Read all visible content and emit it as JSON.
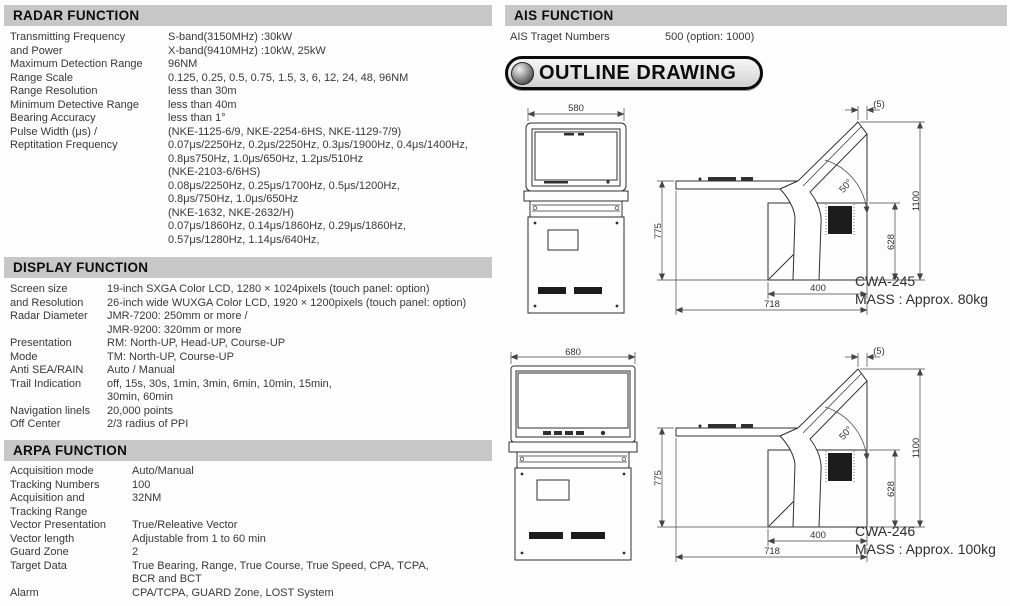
{
  "sections": {
    "radar": {
      "title": "RADAR FUNCTION",
      "rows": [
        {
          "label": "Transmitting Frequency",
          "value": "S-band(3150MHz) :30kW"
        },
        {
          "label": "and Power",
          "value": "X-band(9410MHz) :10kW, 25kW"
        },
        {
          "label": "Maximum Detection Range",
          "value": "96NM"
        },
        {
          "label": "Range Scale",
          "value": "0.125, 0.25, 0.5, 0.75, 1.5, 3, 6, 12, 24, 48, 96NM"
        },
        {
          "label": "Range Resolution",
          "value": "less than 30m"
        },
        {
          "label": "Minimum Detective Range",
          "value": "less than 40m"
        },
        {
          "label": "Bearing Accuracy",
          "value": "less than 1°"
        },
        {
          "label": "Pulse Width (μs) /",
          "value": "(NKE-1125-6/9, NKE-2254-6HS, NKE-1129-7/9)"
        },
        {
          "label": "Reptitation Frequency",
          "value": "0.07μs/2250Hz, 0.2μs/2250Hz, 0.3μs/1900Hz, 0.4μs/1400Hz,"
        },
        {
          "label": "",
          "value": "0.8μs750Hz, 1.0μs/650Hz, 1.2μs/510Hz"
        },
        {
          "label": "",
          "value": "(NKE-2103-6/6HS)"
        },
        {
          "label": "",
          "value": "0.08μs/2250Hz, 0.25μs/1700Hz, 0.5μs/1200Hz,"
        },
        {
          "label": "",
          "value": "0.8μs/750Hz, 1.0μs/650Hz"
        },
        {
          "label": "",
          "value": "(NKE-1632, NKE-2632/H)"
        },
        {
          "label": "",
          "value": "0.07μs/1860Hz, 0.14μs/1860Hz, 0.29μs/1860Hz,"
        },
        {
          "label": "",
          "value": "0.57μs/1280Hz, 1.14μs/640Hz,"
        }
      ]
    },
    "display": {
      "title": "DISPLAY FUNCTION",
      "rows": [
        {
          "label": "Screen size",
          "value": "19-inch SXGA Color LCD, 1280 × 1024pixels (touch panel: option)"
        },
        {
          "label": "and Resolution",
          "value": "26-inch wide WUXGA Color LCD, 1920 × 1200pixels (touch panel: option)"
        },
        {
          "label": "Radar Diameter",
          "value": "JMR-7200: 250mm or more /"
        },
        {
          "label": "",
          "value": "JMR-9200: 320mm or more"
        },
        {
          "label": "Presentation",
          "value": "RM: North-UP, Head-UP, Course-UP"
        },
        {
          "label": "Mode",
          "value": "TM: North-UP, Course-UP"
        },
        {
          "label": "Anti SEA/RAIN",
          "value": "Auto / Manual"
        },
        {
          "label": "Trail Indication",
          "value": "off, 15s, 30s, 1min, 3min, 6min, 10min, 15min,"
        },
        {
          "label": "",
          "value": "30min, 60min"
        },
        {
          "label": "Navigation linels",
          "value": "20,000 points"
        },
        {
          "label": "Off Center",
          "value": "2/3 radius of PPI"
        }
      ]
    },
    "arpa": {
      "title": "ARPA FUNCTION",
      "rows": [
        {
          "label": "Acquisition mode",
          "value": "Auto/Manual"
        },
        {
          "label": "Tracking Numbers",
          "value": "100"
        },
        {
          "label": "Acquisition and",
          "value": "32NM"
        },
        {
          "label": "Tracking Range",
          "value": ""
        },
        {
          "label": "Vector Presentation",
          "value": "True/Releative Vector"
        },
        {
          "label": "Vector length",
          "value": "Adjustable from 1 to 60 min"
        },
        {
          "label": "Guard Zone",
          "value": "2"
        },
        {
          "label": "Target Data",
          "value": "True Bearing, Range, True Course, True Speed, CPA, TCPA,"
        },
        {
          "label": "",
          "value": "BCR and BCT"
        },
        {
          "label": "Alarm",
          "value": "CPA/TCPA, GUARD Zone, LOST System"
        }
      ]
    },
    "ais": {
      "title": "AIS FUNCTION",
      "rows": [
        {
          "label": "AIS Traget Numbers",
          "value": "500 (option: 1000)"
        }
      ]
    }
  },
  "outline": {
    "badge_label": "OUTLINE DRAWING",
    "drawings": [
      {
        "model": "CWA-245",
        "mass": "MASS : Approx. 80kg",
        "front_width": "580",
        "dims": {
          "offset": "(5)",
          "angle": "50°",
          "shelf_height": "775",
          "total_height": "1100",
          "base_height": "628",
          "base_depth": "400",
          "total_depth": "718"
        }
      },
      {
        "model": "CWA-246",
        "mass": "MASS : Approx. 100kg",
        "front_width": "680",
        "dims": {
          "offset": "(5)",
          "angle": "50°",
          "shelf_height": "775",
          "total_height": "1100",
          "base_height": "628",
          "base_depth": "400",
          "total_depth": "718"
        }
      }
    ]
  },
  "colors": {
    "header_bar": "#c7c7c7",
    "text": "#383838",
    "accent": "#0b0b0b"
  }
}
